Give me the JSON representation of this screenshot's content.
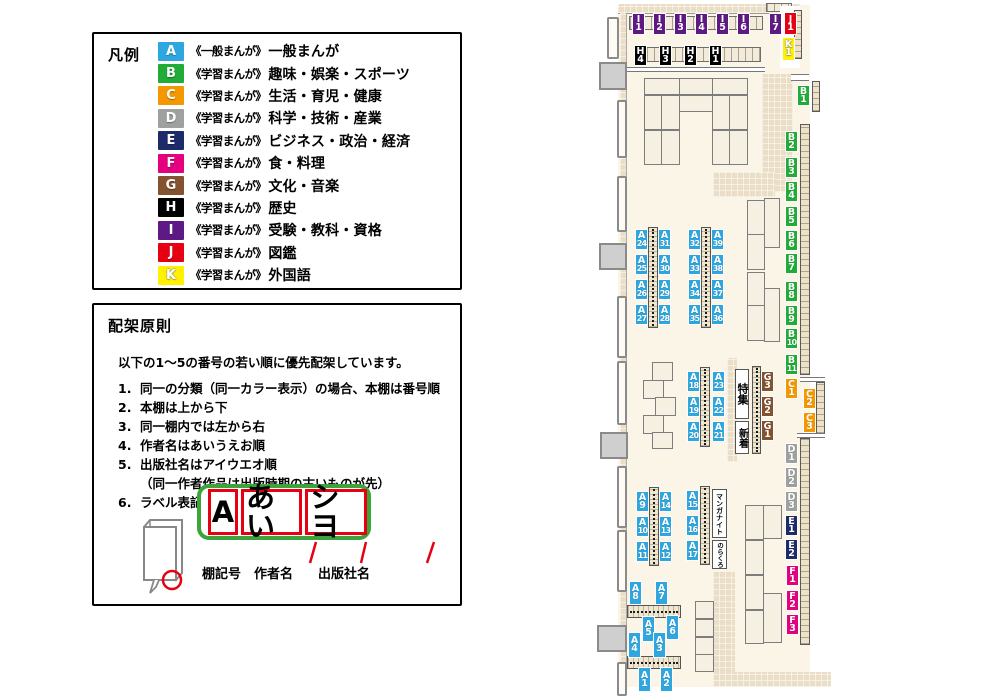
{
  "colors": {
    "A": "#2EA7E0",
    "B": "#21AC38",
    "C": "#F39800",
    "D": "#9FA0A0",
    "E": "#1D2B6B",
    "F": "#E4007F",
    "G": "#84522F",
    "H": "#000000",
    "I": "#5F1985",
    "J": "#E60012",
    "K": "#FFF100"
  },
  "legend": {
    "title": "凡例",
    "rows": [
      {
        "code": "A",
        "series": "《一般まんが》",
        "category": "一般まんが"
      },
      {
        "code": "B",
        "series": "《学習まんが》",
        "category": "趣味・娯楽・スポーツ"
      },
      {
        "code": "C",
        "series": "《学習まんが》",
        "category": "生活・育児・健康"
      },
      {
        "code": "D",
        "series": "《学習まんが》",
        "category": "科学・技術・産業"
      },
      {
        "code": "E",
        "series": "《学習まんが》",
        "category": "ビジネス・政治・経済"
      },
      {
        "code": "F",
        "series": "《学習まんが》",
        "category": "食・料理"
      },
      {
        "code": "G",
        "series": "《学習まんが》",
        "category": "文化・音楽"
      },
      {
        "code": "H",
        "series": "《学習まんが》",
        "category": "歴史"
      },
      {
        "code": "I",
        "series": "《学習まんが》",
        "category": "受験・教科・資格"
      },
      {
        "code": "J",
        "series": "《学習まんが》",
        "category": "図鑑"
      },
      {
        "code": "K",
        "series": "《学習まんが》",
        "category": "外国語"
      }
    ]
  },
  "rules": {
    "title": "配架原則",
    "intro": "以下の1～5の番号の若い順に優先配架しています。",
    "items": [
      {
        "num": "1.",
        "text": "同一の分類（同一カラー表示）の場合、本棚は番号順"
      },
      {
        "num": "2.",
        "text": "本棚は上から下"
      },
      {
        "num": "3.",
        "text": "同一棚内では左から右"
      },
      {
        "num": "4.",
        "text": "作者名はあいうえお順"
      },
      {
        "num": "5.",
        "text": "出版社名はアイウエオ順",
        "sub": "（同一作者作品は出版時期の古いものが先）"
      },
      {
        "num": "6.",
        "text": "ラベル表記は下図の通り"
      }
    ],
    "label_example": {
      "shelf_code": "A",
      "author": "あい",
      "publisher": "シヨ",
      "callouts": [
        "棚記号",
        "作者名",
        "出版社名"
      ]
    }
  },
  "map": {
    "features": {
      "special": "特集",
      "new_arrivals": "新着",
      "manga_night": "マンガナイト",
      "norakuro": "のらくろ"
    },
    "labels": [
      {
        "c": "I1",
        "x": 632,
        "y": 13,
        "h": 22
      },
      {
        "c": "I2",
        "x": 653,
        "y": 13,
        "h": 22
      },
      {
        "c": "I3",
        "x": 674,
        "y": 13,
        "h": 22
      },
      {
        "c": "I4",
        "x": 695,
        "y": 13,
        "h": 22
      },
      {
        "c": "I5",
        "x": 716,
        "y": 13,
        "h": 22
      },
      {
        "c": "I6",
        "x": 737,
        "y": 13,
        "h": 22
      },
      {
        "c": "I7",
        "x": 769,
        "y": 13,
        "h": 22
      },
      {
        "c": "J1",
        "x": 784,
        "y": 12,
        "h": 23
      },
      {
        "c": "K1",
        "x": 782,
        "y": 37,
        "h": 24
      },
      {
        "c": "H4",
        "x": 634,
        "y": 45,
        "h": 21
      },
      {
        "c": "H3",
        "x": 659,
        "y": 45,
        "h": 21
      },
      {
        "c": "H2",
        "x": 684,
        "y": 45,
        "h": 21
      },
      {
        "c": "H1",
        "x": 709,
        "y": 45,
        "h": 21
      },
      {
        "c": "B1",
        "x": 797,
        "y": 85
      },
      {
        "c": "B2",
        "x": 785,
        "y": 131
      },
      {
        "c": "B3",
        "x": 785,
        "y": 157
      },
      {
        "c": "B4",
        "x": 785,
        "y": 181
      },
      {
        "c": "B5",
        "x": 785,
        "y": 206
      },
      {
        "c": "B6",
        "x": 785,
        "y": 230
      },
      {
        "c": "B7",
        "x": 785,
        "y": 253
      },
      {
        "c": "B8",
        "x": 785,
        "y": 281
      },
      {
        "c": "B9",
        "x": 785,
        "y": 305
      },
      {
        "c": "B10",
        "x": 785,
        "y": 328
      },
      {
        "c": "B11",
        "x": 785,
        "y": 354
      },
      {
        "c": "C1",
        "x": 785,
        "y": 378
      },
      {
        "c": "C2",
        "x": 803,
        "y": 388
      },
      {
        "c": "C3",
        "x": 803,
        "y": 412
      },
      {
        "c": "D1",
        "x": 785,
        "y": 443
      },
      {
        "c": "D2",
        "x": 785,
        "y": 467
      },
      {
        "c": "D3",
        "x": 785,
        "y": 491
      },
      {
        "c": "E1",
        "x": 785,
        "y": 515
      },
      {
        "c": "E2",
        "x": 785,
        "y": 539
      },
      {
        "c": "F1",
        "x": 786,
        "y": 565
      },
      {
        "c": "F2",
        "x": 786,
        "y": 590
      },
      {
        "c": "F3",
        "x": 786,
        "y": 614
      },
      {
        "c": "G3",
        "x": 761,
        "y": 371
      },
      {
        "c": "G2",
        "x": 761,
        "y": 396
      },
      {
        "c": "G1",
        "x": 761,
        "y": 420
      },
      {
        "c": "A24",
        "x": 635,
        "y": 229
      },
      {
        "c": "A31",
        "x": 658,
        "y": 229
      },
      {
        "c": "A25",
        "x": 635,
        "y": 254
      },
      {
        "c": "A30",
        "x": 658,
        "y": 254
      },
      {
        "c": "A26",
        "x": 635,
        "y": 279
      },
      {
        "c": "A29",
        "x": 658,
        "y": 279
      },
      {
        "c": "A27",
        "x": 635,
        "y": 304
      },
      {
        "c": "A28",
        "x": 658,
        "y": 304
      },
      {
        "c": "A32",
        "x": 688,
        "y": 229
      },
      {
        "c": "A39",
        "x": 711,
        "y": 229
      },
      {
        "c": "A33",
        "x": 688,
        "y": 254
      },
      {
        "c": "A38",
        "x": 711,
        "y": 254
      },
      {
        "c": "A34",
        "x": 688,
        "y": 279
      },
      {
        "c": "A37",
        "x": 711,
        "y": 279
      },
      {
        "c": "A35",
        "x": 688,
        "y": 304
      },
      {
        "c": "A36",
        "x": 711,
        "y": 304
      },
      {
        "c": "A18",
        "x": 687,
        "y": 371
      },
      {
        "c": "A23",
        "x": 712,
        "y": 371
      },
      {
        "c": "A19",
        "x": 687,
        "y": 396
      },
      {
        "c": "A22",
        "x": 712,
        "y": 396
      },
      {
        "c": "A20",
        "x": 687,
        "y": 421
      },
      {
        "c": "A21",
        "x": 712,
        "y": 421
      },
      {
        "c": "A9",
        "x": 636,
        "y": 491
      },
      {
        "c": "A14",
        "x": 659,
        "y": 491
      },
      {
        "c": "A10",
        "x": 636,
        "y": 516
      },
      {
        "c": "A13",
        "x": 659,
        "y": 516
      },
      {
        "c": "A11",
        "x": 636,
        "y": 541
      },
      {
        "c": "A12",
        "x": 659,
        "y": 541
      },
      {
        "c": "A15",
        "x": 686,
        "y": 490
      },
      {
        "c": "A16",
        "x": 686,
        "y": 515
      },
      {
        "c": "A17",
        "x": 686,
        "y": 540
      },
      {
        "c": "A8",
        "x": 629,
        "y": 581,
        "h": 24
      },
      {
        "c": "A7",
        "x": 655,
        "y": 581,
        "h": 24
      },
      {
        "c": "A5",
        "x": 642,
        "y": 616,
        "h": 26
      },
      {
        "c": "A6",
        "x": 666,
        "y": 615,
        "h": 25
      },
      {
        "c": "A4",
        "x": 628,
        "y": 632,
        "h": 26
      },
      {
        "c": "A3",
        "x": 653,
        "y": 632,
        "h": 26
      },
      {
        "c": "A1",
        "x": 638,
        "y": 667,
        "h": 25
      },
      {
        "c": "A2",
        "x": 660,
        "y": 667,
        "h": 25
      }
    ]
  }
}
